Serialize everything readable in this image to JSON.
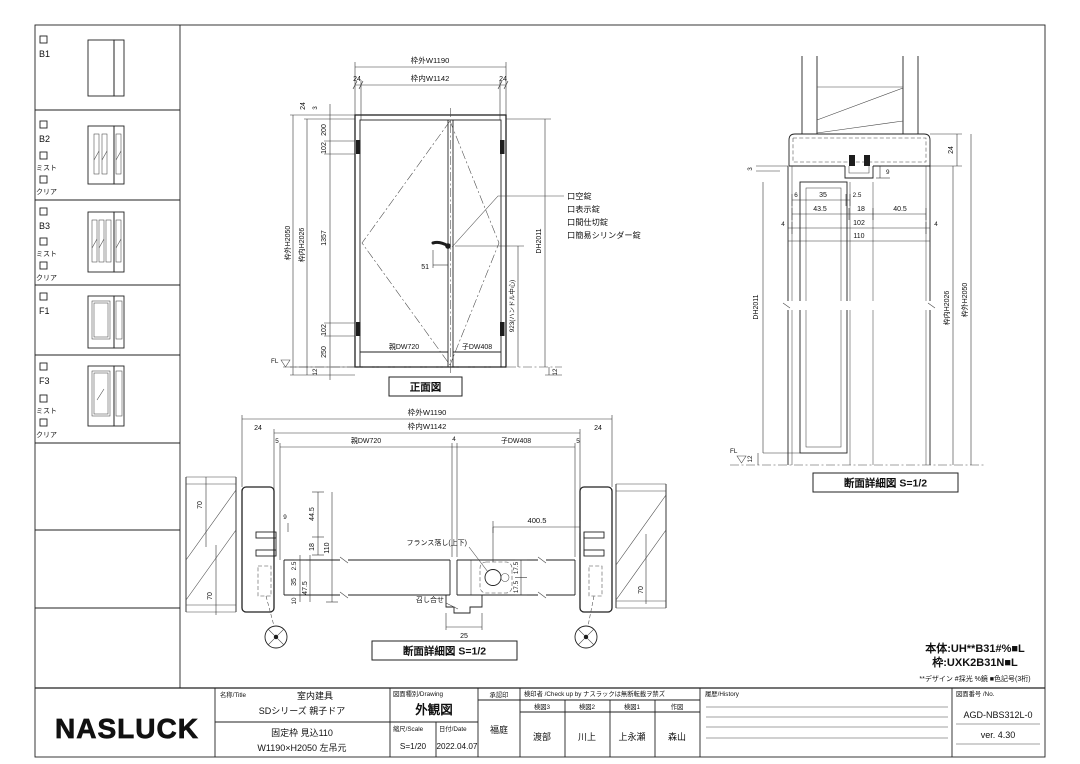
{
  "sidebar": {
    "variants": [
      {
        "label": "B1",
        "options": []
      },
      {
        "label": "B2",
        "options": [
          "ミスト",
          "クリア"
        ]
      },
      {
        "label": "B3",
        "options": [
          "ミスト",
          "クリア"
        ]
      },
      {
        "label": "F1",
        "options": []
      },
      {
        "label": "F3",
        "options": [
          "ミスト",
          "クリア"
        ]
      }
    ]
  },
  "front_view": {
    "title": "正面図",
    "top_dims": {
      "outer": "枠外W1190",
      "inner": "枠内W1142",
      "left": "24",
      "right": "24"
    },
    "left_dims": {
      "overall": "枠外H2050",
      "inner": "枠内H2026",
      "chain": [
        "24",
        "3",
        "200",
        "102",
        "1357",
        "102",
        "250"
      ],
      "below_fl": "12"
    },
    "right_dims": {
      "door_height": "DH2011",
      "handle": "923(ハンドル中心)",
      "below_fl": "12"
    },
    "leaf_labels": {
      "parent": "親DW720",
      "child": "子DW408"
    },
    "handle_dim": "51",
    "fl": "FL",
    "locks": [
      "口空錠",
      "口表示錠",
      "口間仕切錠",
      "口簡易シリンダー錠"
    ]
  },
  "v_section": {
    "title": "断面詳細図 S=1/2",
    "dims": {
      "gap3": "3",
      "head24": "24",
      "w6": "6",
      "w35": "35",
      "w2_5": "2.5",
      "w43_5": "43.5",
      "w18": "18",
      "w40_5": "40.5",
      "e4a": "4",
      "w102": "102",
      "e4b": "4",
      "w110": "110",
      "stop9": "9",
      "below12": "12"
    },
    "vdims": {
      "door_height": "DH2011",
      "inner": "枠内H2026",
      "outer": "枠外H2050"
    },
    "fl": "FL"
  },
  "h_section": {
    "title": "断面詳細図 S=1/2",
    "top_dims": {
      "outer": "枠外W1190",
      "left24": "24",
      "inner": "枠内W1142",
      "right24": "24",
      "gap5l": "5",
      "parent": "親DW720",
      "gap4": "4",
      "child": "子DW408",
      "gap5r": "5"
    },
    "left_dims": {
      "wall_top": "70",
      "stop9": "9",
      "d44_5": "44.5",
      "d18": "18",
      "d110": "110",
      "d2_5": "2.5",
      "d35": "35",
      "d47_5": "47.5",
      "d10": "10",
      "wall_bottom": "70"
    },
    "mid_dims": {
      "bolt_offset": "400.5",
      "t17a": "17.5",
      "t17b": "17.5",
      "meet25": "25"
    },
    "right_dims": {
      "wall": "70"
    },
    "annotations": {
      "flush_bolt": "フランス落し(上下)",
      "meeting": "召し合せ"
    }
  },
  "notes": {
    "body": "本体:UH**B31#%■L",
    "frame": "枠:UXK2B31N■L",
    "legend": "**デザイン #採光 %鏡 ■色記号(3桁)"
  },
  "title_block": {
    "logo": "NASLUCK",
    "name_header": "名称/Title",
    "name_line1": "室内建具",
    "name_line2": "SDシリーズ 親子ドア",
    "spec_line1": "固定枠 見込110",
    "spec_line2": "W1190×H2050 左吊元",
    "drawing_header": "図面種別/Drawing",
    "drawing_name": "外観図",
    "scale_header": "縮尺/Scale",
    "scale_value": "S=1/20",
    "date_header": "日付/Date",
    "date_value": "2022.04.07",
    "approval_header": "承認印",
    "approver": "福庭",
    "check_header": "検印者 /Check up by ナスラックは無断転載ヲ禁ズ",
    "check_cols": [
      {
        "role": "検図3",
        "name": "渡部"
      },
      {
        "role": "検図2",
        "name": "川上"
      },
      {
        "role": "検図1",
        "name": "上永瀬"
      },
      {
        "role": "作図",
        "name": "森山"
      }
    ],
    "history_header": "履歴/History",
    "number_header": "図面番号 /No.",
    "number": "AGD-NBS312L-0",
    "version": "ver. 4.30"
  }
}
